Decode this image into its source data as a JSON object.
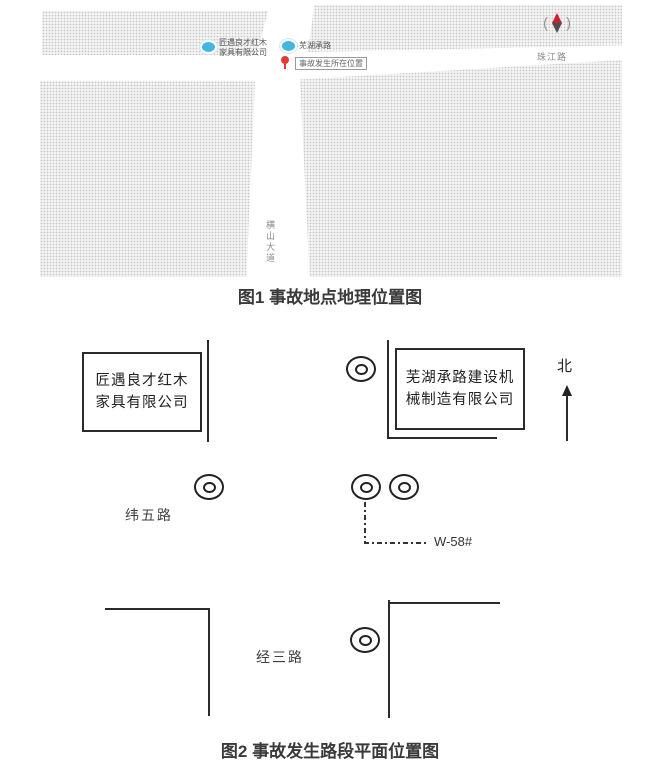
{
  "figure1": {
    "caption": "图1 事故地点地理位置图",
    "map": {
      "poi_left_line1": "匠遇良才红木",
      "poi_left_line2": "家具有限公司",
      "poi_right_name": "芜湖承路",
      "accident_box_label": "事故发生所在位置",
      "road_zhujiang": "珠江路",
      "road_hengshan": "横山大道",
      "compass_left_glyph": "(",
      "compass_right_glyph": ")"
    }
  },
  "figure2": {
    "caption": "图2 事故发生路段平面位置图",
    "left_company_line1": "匠遇良才红木",
    "left_company_line2": "家具有限公司",
    "right_company_line1": "芜湖承路建设机",
    "right_company_line2": "械制造有限公司",
    "north_label": "北",
    "road_weiwu": "纬五路",
    "road_jingsan": "经三路",
    "well_label": "W-58#"
  },
  "colors": {
    "poi_blue": "#45b6e0",
    "pin_red": "#e03c31",
    "diagram_line": "#2b2b2b"
  }
}
